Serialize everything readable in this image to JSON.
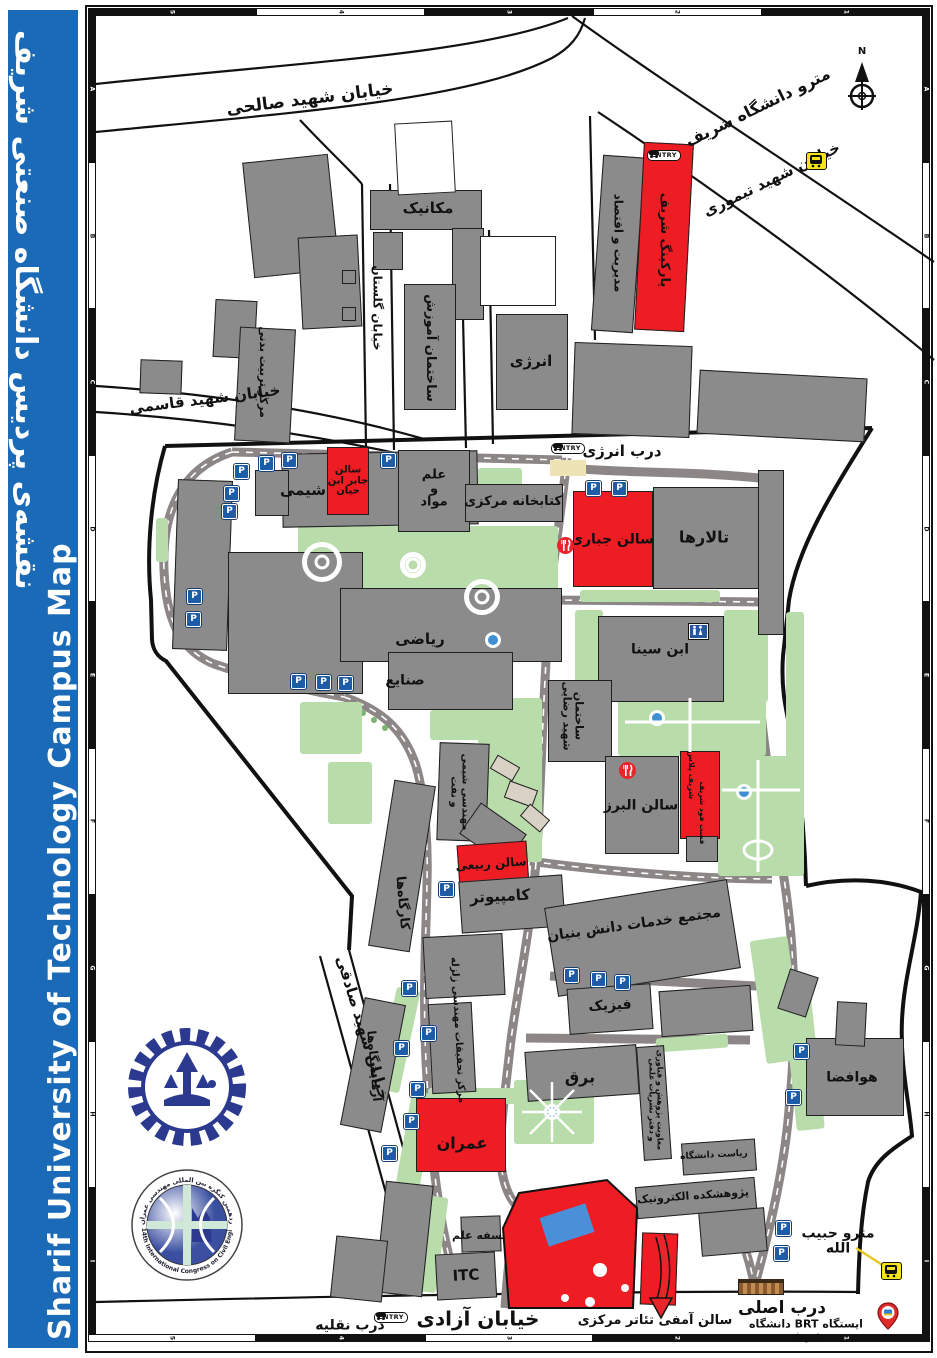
{
  "sidebar": {
    "title_fa": "نقشه‌ی پردیس دانشگاه صنعتی شریف",
    "title_en": "Sharif University of Technology Campus Map"
  },
  "frame": {
    "top": [
      {
        "l": "5",
        "c": "b"
      },
      {
        "l": "4",
        "c": "w"
      },
      {
        "l": "3",
        "c": "b"
      },
      {
        "l": "2",
        "c": "w"
      },
      {
        "l": "1",
        "c": "b"
      }
    ],
    "bottom": [
      {
        "l": "5",
        "c": "w"
      },
      {
        "l": "4",
        "c": "b"
      },
      {
        "l": "3",
        "c": "w"
      },
      {
        "l": "2",
        "c": "b"
      },
      {
        "l": "1",
        "c": "b"
      }
    ],
    "side": [
      "A",
      "B",
      "C",
      "D",
      "E",
      "F",
      "G",
      "H",
      "I"
    ]
  },
  "icons": {
    "parking": "P",
    "entry": "ENTRY",
    "north": "N"
  },
  "logos": {
    "congress_fa": "چهاردهمین کنگره بین المللی مهندسی عمران",
    "congress_en": "14th International Congress on Civil Engineering"
  },
  "colors": {
    "building_gray": "#8b8b8b",
    "highlight_red": "#ee1c23",
    "green": "#b9dcab",
    "road_gray": "#8d8687",
    "metro_yellow": "#f6e41b",
    "sidebar_blue": "#1a6ab8"
  },
  "map": {
    "labels": [
      {
        "t": "خیابان شهید صالحی",
        "x": 310,
        "y": 100,
        "r": -7,
        "s": 17
      },
      {
        "t": "مترو دانشگاه شریف",
        "x": 758,
        "y": 108,
        "r": -26,
        "s": 16
      },
      {
        "t": "خیابان شهید تیموری",
        "x": 772,
        "y": 180,
        "r": -26,
        "s": 15
      },
      {
        "t": "خیابان گلستان",
        "x": 377,
        "y": 308,
        "r": 90,
        "s": 12
      },
      {
        "t": "خیابان شهید قاسمی",
        "x": 205,
        "y": 400,
        "r": -7,
        "s": 15
      },
      {
        "t": "درب انرژی",
        "x": 622,
        "y": 452,
        "r": 0,
        "s": 15
      },
      {
        "t": "خیابان شهید صادقی",
        "x": 362,
        "y": 1028,
        "r": 73,
        "s": 15
      },
      {
        "t": "خیابان آزادی",
        "x": 478,
        "y": 1319,
        "r": 0,
        "s": 20
      },
      {
        "t": "درب نقلیه",
        "x": 350,
        "y": 1326,
        "r": 0,
        "s": 14
      },
      {
        "t": "سالن آمفی تئاتر مرکزی",
        "x": 655,
        "y": 1321,
        "r": 0,
        "s": 13
      },
      {
        "t": "درب اصلی",
        "x": 782,
        "y": 1309,
        "r": 0,
        "s": 17
      },
      {
        "t": "ایستگاه BRT دانشگاه شریف",
        "x": 806,
        "y": 1330,
        "r": 0,
        "s": 11
      },
      {
        "t": "مترو حبیب الله",
        "x": 838,
        "y": 1241,
        "r": 0,
        "s": 14
      },
      {
        "t": "مکانیک",
        "x": 428,
        "y": 209,
        "r": 0,
        "s": 15
      },
      {
        "t": "ساختمان آموزش",
        "x": 430,
        "y": 348,
        "r": 90,
        "s": 13
      },
      {
        "t": "مرکز تربیت بدنی",
        "x": 263,
        "y": 372,
        "r": 90,
        "s": 11
      },
      {
        "t": "انرژی",
        "x": 531,
        "y": 362,
        "r": 0,
        "s": 15
      },
      {
        "t": "مدیریت و اقتصاد",
        "x": 618,
        "y": 243,
        "r": 90,
        "s": 12
      },
      {
        "t": "پارکینگ شریف",
        "x": 664,
        "y": 240,
        "r": 90,
        "s": 13
      },
      {
        "t": "شیمی",
        "x": 303,
        "y": 491,
        "r": 0,
        "s": 15
      },
      {
        "t": "سالن\nجابر ابن\nحیان",
        "x": 348,
        "y": 481,
        "r": 0,
        "s": 10
      },
      {
        "t": "علم\nو\nمواد",
        "x": 434,
        "y": 489,
        "r": 0,
        "s": 13
      },
      {
        "t": "کتابخانه مرکزی",
        "x": 513,
        "y": 502,
        "r": 0,
        "s": 13
      },
      {
        "t": "سالن جباری",
        "x": 612,
        "y": 540,
        "r": 0,
        "s": 14
      },
      {
        "t": "تالارها",
        "x": 704,
        "y": 538,
        "r": 0,
        "s": 16
      },
      {
        "t": "ابن سینا",
        "x": 660,
        "y": 650,
        "r": 0,
        "s": 14
      },
      {
        "t": "ریاضی",
        "x": 420,
        "y": 640,
        "r": 0,
        "s": 15
      },
      {
        "t": "صنایع",
        "x": 405,
        "y": 681,
        "r": 0,
        "s": 14
      },
      {
        "t": "ساختمان\nشهید رضایی",
        "x": 573,
        "y": 716,
        "r": 90,
        "s": 11
      },
      {
        "t": "مهندسی شیمی\nو نفت",
        "x": 459,
        "y": 792,
        "r": 90,
        "s": 10
      },
      {
        "t": "سالن البرز",
        "x": 641,
        "y": 806,
        "r": 0,
        "s": 14
      },
      {
        "t": "شریف پلاس",
        "x": 691,
        "y": 775,
        "r": 90,
        "s": 8
      },
      {
        "t": "فست فود شریف",
        "x": 702,
        "y": 813,
        "r": 90,
        "s": 7.5
      },
      {
        "t": "سالن ربیعی",
        "x": 491,
        "y": 864,
        "r": -4,
        "s": 12
      },
      {
        "t": "کامپیوتر",
        "x": 500,
        "y": 897,
        "r": -3,
        "s": 15
      },
      {
        "t": "کارگاه‌ها",
        "x": 402,
        "y": 903,
        "r": 85,
        "s": 13
      },
      {
        "t": "مجتمع خدمات دانش بنیان",
        "x": 634,
        "y": 925,
        "r": -8,
        "s": 14
      },
      {
        "t": "فیزیک",
        "x": 610,
        "y": 1006,
        "r": -3,
        "s": 14
      },
      {
        "t": "برق",
        "x": 580,
        "y": 1078,
        "r": 0,
        "s": 16
      },
      {
        "t": "معاونت پژوهش و فناوری\nو دفتر نشریات علمی",
        "x": 655,
        "y": 1100,
        "r": 90,
        "s": 8
      },
      {
        "t": "ریاست دانشگاه",
        "x": 714,
        "y": 1156,
        "r": -3,
        "s": 9
      },
      {
        "t": "پژوهشکده الکترونیک",
        "x": 693,
        "y": 1196,
        "r": -4,
        "s": 11
      },
      {
        "t": "هوافضا",
        "x": 852,
        "y": 1078,
        "r": 0,
        "s": 14
      },
      {
        "t": "آزمایشگاه‌ها",
        "x": 374,
        "y": 1066,
        "r": 85,
        "s": 12
      },
      {
        "t": "مرکز تحقیقات مهندسی زلزله",
        "x": 457,
        "y": 1030,
        "r": 87,
        "s": 10
      },
      {
        "t": "عمران",
        "x": 462,
        "y": 1144,
        "r": 0,
        "s": 16
      },
      {
        "t": "فلسفه علم",
        "x": 483,
        "y": 1236,
        "r": 0,
        "s": 11
      },
      {
        "t": "ITC",
        "x": 466,
        "y": 1276,
        "r": -3,
        "s": 15
      },
      {
        "t": "مسجد",
        "x": 552,
        "y": 1276,
        "r": -12,
        "s": 15
      },
      {
        "t": "N",
        "x": 862,
        "y": 52,
        "r": 0,
        "s": 10
      }
    ],
    "buildings": [
      [
        370,
        190,
        112,
        40,
        0,
        "g"
      ],
      [
        373,
        232,
        30,
        38,
        0,
        "g"
      ],
      [
        452,
        228,
        32,
        92,
        0,
        "g"
      ],
      [
        248,
        158,
        86,
        116,
        -6,
        "g"
      ],
      [
        214,
        300,
        42,
        58,
        3,
        "g"
      ],
      [
        300,
        236,
        60,
        92,
        -3,
        "g"
      ],
      [
        342,
        270,
        14,
        14,
        0,
        "g"
      ],
      [
        342,
        307,
        14,
        14,
        0,
        "g"
      ],
      [
        237,
        328,
        56,
        114,
        3,
        "g"
      ],
      [
        140,
        360,
        42,
        34,
        2,
        "g"
      ],
      [
        404,
        284,
        52,
        126,
        0,
        "g"
      ],
      [
        496,
        314,
        72,
        96,
        0,
        "g"
      ],
      [
        597,
        156,
        42,
        176,
        4,
        "g"
      ],
      [
        639,
        143,
        50,
        188,
        3,
        "r"
      ],
      [
        573,
        344,
        118,
        92,
        2,
        "g"
      ],
      [
        698,
        374,
        168,
        64,
        3,
        "g"
      ],
      [
        396,
        122,
        58,
        72,
        -3,
        "w"
      ],
      [
        480,
        236,
        76,
        70,
        0,
        "w"
      ],
      [
        282,
        452,
        196,
        74,
        -1,
        "g"
      ],
      [
        255,
        470,
        34,
        46,
        0,
        "g"
      ],
      [
        327,
        447,
        42,
        68,
        0,
        "r"
      ],
      [
        398,
        450,
        72,
        82,
        0,
        "g"
      ],
      [
        465,
        484,
        98,
        38,
        0,
        "g"
      ],
      [
        573,
        491,
        80,
        96,
        0,
        "r"
      ],
      [
        653,
        487,
        110,
        102,
        0,
        "g"
      ],
      [
        758,
        470,
        26,
        165,
        0,
        "g"
      ],
      [
        598,
        616,
        126,
        86,
        0,
        "g"
      ],
      [
        548,
        680,
        64,
        82,
        0,
        "g"
      ],
      [
        175,
        480,
        55,
        170,
        2,
        "g"
      ],
      [
        228,
        552,
        135,
        142,
        0,
        "g"
      ],
      [
        340,
        588,
        222,
        74,
        0,
        "g"
      ],
      [
        388,
        652,
        125,
        58,
        0,
        "g"
      ],
      [
        605,
        756,
        74,
        98,
        0,
        "g"
      ],
      [
        680,
        751,
        40,
        88,
        0,
        "r"
      ],
      [
        686,
        836,
        32,
        26,
        0,
        "g"
      ],
      [
        438,
        743,
        50,
        98,
        2,
        "g"
      ],
      [
        465,
        815,
        56,
        38,
        35,
        "g"
      ],
      [
        458,
        843,
        70,
        44,
        -4,
        "r"
      ],
      [
        460,
        878,
        104,
        52,
        -4,
        "g"
      ],
      [
        381,
        782,
        42,
        168,
        9,
        "g"
      ],
      [
        550,
        893,
        185,
        90,
        -9,
        "g"
      ],
      [
        568,
        986,
        84,
        46,
        -4,
        "g"
      ],
      [
        660,
        988,
        92,
        46,
        -4,
        "g"
      ],
      [
        526,
        1048,
        112,
        50,
        -4,
        "g"
      ],
      [
        640,
        1046,
        28,
        114,
        -4,
        "g"
      ],
      [
        682,
        1141,
        74,
        32,
        -4,
        "g"
      ],
      [
        636,
        1182,
        120,
        32,
        -5,
        "g"
      ],
      [
        700,
        1210,
        66,
        44,
        -5,
        "g"
      ],
      [
        806,
        1038,
        98,
        78,
        0,
        "g"
      ],
      [
        783,
        972,
        30,
        42,
        18,
        "g"
      ],
      [
        836,
        1002,
        30,
        44,
        3,
        "g"
      ],
      [
        352,
        1000,
        42,
        130,
        11,
        "g"
      ],
      [
        430,
        1003,
        44,
        90,
        -3,
        "g"
      ],
      [
        424,
        935,
        80,
        62,
        -3,
        "g"
      ],
      [
        416,
        1098,
        90,
        74,
        0,
        "r"
      ],
      [
        380,
        1183,
        48,
        112,
        6,
        "g"
      ],
      [
        333,
        1238,
        52,
        62,
        6,
        "g"
      ],
      [
        461,
        1216,
        40,
        36,
        -2,
        "g"
      ],
      [
        436,
        1253,
        60,
        46,
        -3,
        "g"
      ],
      [
        641,
        1233,
        36,
        72,
        2,
        "r"
      ],
      [
        492,
        760,
        26,
        16,
        30,
        "t"
      ],
      [
        506,
        785,
        30,
        18,
        20,
        "t"
      ],
      [
        522,
        810,
        26,
        16,
        40,
        "t"
      ]
    ],
    "greens": [
      [
        298,
        526,
        260,
        88
      ],
      [
        575,
        610,
        28,
        92
      ],
      [
        724,
        610,
        44,
        92
      ],
      [
        618,
        692,
        148,
        64
      ],
      [
        718,
        756,
        86,
        120
      ],
      [
        786,
        612,
        18,
        250
      ],
      [
        478,
        698,
        64,
        164
      ],
      [
        300,
        702,
        62,
        52
      ],
      [
        328,
        762,
        44,
        62
      ],
      [
        430,
        710,
        62,
        30
      ],
      [
        428,
        1088,
        104,
        16
      ],
      [
        514,
        1080,
        80,
        64
      ],
      [
        790,
        998,
        28,
        132,
        -6
      ],
      [
        386,
        988,
        24,
        104,
        12
      ],
      [
        403,
        1092,
        24,
        104,
        10
      ],
      [
        418,
        1196,
        24,
        96,
        8
      ],
      [
        538,
        1188,
        24,
        72,
        0
      ],
      [
        478,
        468,
        44,
        32
      ],
      [
        656,
        1036,
        72,
        14,
        -4
      ],
      [
        758,
        938,
        38,
        124,
        -8
      ],
      [
        156,
        518,
        12,
        44
      ],
      [
        580,
        590,
        140,
        12
      ]
    ],
    "parking": [
      [
        240,
        470
      ],
      [
        265,
        462
      ],
      [
        288,
        459
      ],
      [
        387,
        459
      ],
      [
        230,
        492
      ],
      [
        228,
        510
      ],
      [
        193,
        595
      ],
      [
        192,
        618
      ],
      [
        297,
        680
      ],
      [
        322,
        681
      ],
      [
        344,
        682
      ],
      [
        592,
        487
      ],
      [
        618,
        487
      ],
      [
        445,
        888
      ],
      [
        570,
        974
      ],
      [
        597,
        978
      ],
      [
        621,
        981
      ],
      [
        800,
        1050
      ],
      [
        792,
        1096
      ],
      [
        408,
        987
      ],
      [
        427,
        1032
      ],
      [
        400,
        1047
      ],
      [
        416,
        1088
      ],
      [
        410,
        1120
      ],
      [
        388,
        1152
      ],
      [
        782,
        1227
      ],
      [
        780,
        1252
      ]
    ],
    "entries": [
      [
        551,
        443
      ],
      [
        647,
        150
      ],
      [
        374,
        1312
      ]
    ],
    "metros": [
      [
        806,
        152
      ],
      [
        881,
        1262
      ]
    ],
    "restaurants": [
      [
        557,
        537
      ],
      [
        619,
        762
      ]
    ],
    "wc": [
      689,
      624
    ],
    "dots": [
      [
        493,
        640
      ],
      [
        657,
        718
      ],
      [
        744,
        792
      ],
      [
        552,
        1112
      ]
    ],
    "fountains": [
      [
        322,
        562,
        20
      ],
      [
        413,
        565,
        13
      ],
      [
        482,
        597,
        18
      ]
    ]
  }
}
